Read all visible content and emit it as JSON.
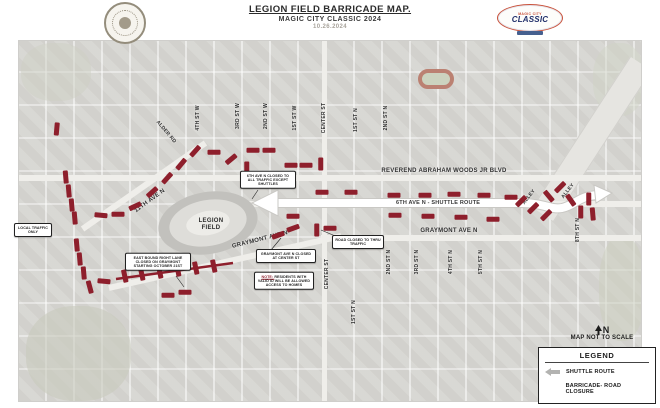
{
  "header": {
    "title": "LEGION FIELD BARRICADE MAP.",
    "subtitle": "MAGIC CITY CLASSIC 2024",
    "date": "10.26.2024"
  },
  "logos": {
    "classic": {
      "line1": "MAGIC CITY",
      "line2": "CLASSIC"
    }
  },
  "north": {
    "label": "N",
    "note": "MAP NOT TO SCALE"
  },
  "legend": {
    "title": "LEGEND",
    "items": [
      {
        "icon": "shuttle-arrow-icon",
        "label": "SHUTTLE ROUTE"
      },
      {
        "icon": "barricade-swatch",
        "label": "BARRICADE- ROAD CLOSURE"
      }
    ]
  },
  "map": {
    "stadium_label": "LEGION FIELD",
    "route_label": "6TH AVE N - SHUTTLE ROUTE",
    "colors": {
      "barricade": "#8e1f2c",
      "route": "#ffffff",
      "map_bg": "#d7d6d2"
    },
    "streets": [
      {
        "label": "ALDER RD",
        "x": 166,
        "y": 132,
        "rot": 50,
        "size": 5
      },
      {
        "label": "4TH ST W",
        "x": 198,
        "y": 118,
        "rot": -90,
        "size": 5
      },
      {
        "label": "3RD ST W",
        "x": 238,
        "y": 116,
        "rot": -90,
        "size": 5
      },
      {
        "label": "2ND ST W",
        "x": 266,
        "y": 116,
        "rot": -90,
        "size": 5
      },
      {
        "label": "1ST ST W",
        "x": 295,
        "y": 118,
        "rot": -90,
        "size": 5
      },
      {
        "label": "CENTER ST",
        "x": 324,
        "y": 118,
        "rot": -90,
        "size": 5
      },
      {
        "label": "1ST ST N",
        "x": 356,
        "y": 120,
        "rot": -90,
        "size": 5
      },
      {
        "label": "2ND ST N",
        "x": 386,
        "y": 118,
        "rot": -90,
        "size": 5
      },
      {
        "label": "REVEREND ABRAHAM WOODS JR BLVD",
        "x": 444,
        "y": 171,
        "rot": 0,
        "size": 6
      },
      {
        "label": "GRAYMONT AVE N",
        "x": 449,
        "y": 231,
        "rot": 0,
        "size": 6
      },
      {
        "label": "GRAYMONT AVE N",
        "x": 260,
        "y": 240,
        "rot": -14,
        "size": 6
      },
      {
        "label": "11TH AVE N",
        "x": 150,
        "y": 201,
        "rot": -36,
        "size": 6
      },
      {
        "label": "2ND ST N",
        "x": 389,
        "y": 262,
        "rot": -90,
        "size": 5
      },
      {
        "label": "3RD ST N",
        "x": 417,
        "y": 262,
        "rot": -90,
        "size": 5
      },
      {
        "label": "4TH ST N",
        "x": 451,
        "y": 262,
        "rot": -90,
        "size": 5
      },
      {
        "label": "5TH ST N",
        "x": 481,
        "y": 262,
        "rot": -90,
        "size": 5
      },
      {
        "label": "CENTER ST",
        "x": 327,
        "y": 274,
        "rot": -90,
        "size": 5
      },
      {
        "label": "1ST ST N",
        "x": 354,
        "y": 312,
        "rot": -90,
        "size": 5
      },
      {
        "label": "ALLEY",
        "x": 529,
        "y": 197,
        "rot": -52,
        "size": 5
      },
      {
        "label": "ALLEY",
        "x": 568,
        "y": 191,
        "rot": -52,
        "size": 5
      },
      {
        "label": "8TH ST N",
        "x": 578,
        "y": 230,
        "rot": -90,
        "size": 5
      }
    ],
    "callouts": [
      {
        "x": 158,
        "y": 262,
        "w": 60,
        "text": "EAST BOUND RIGHT LANE CLOSED ON GRAYMONT STARTING OCTOBER 21ST"
      },
      {
        "x": 268,
        "y": 180,
        "w": 50,
        "text": "6TH AVE N CLOSED TO ALL TRAFFIC EXCEPT SHUTTLES"
      },
      {
        "x": 286,
        "y": 256,
        "w": 54,
        "text": "GRAYMONT AVE N CLOSED AT CENTER ST"
      },
      {
        "x": 284,
        "y": 281,
        "w": 54,
        "highlight": "NOTE:",
        "text": "RESIDENTS WITH VALID ID WILL BE ALLOWED ACCESS TO HOMES"
      },
      {
        "x": 358,
        "y": 242,
        "w": 46,
        "text": "ROAD CLOSED TO THRU TRAFFIC"
      },
      {
        "x": 33,
        "y": 230,
        "w": 32,
        "text": "LOCAL TRAFFIC ONLY"
      }
    ],
    "leader_lines": [
      {
        "x1": 176,
        "y1": 276,
        "x2": 184,
        "y2": 287
      },
      {
        "x1": 258,
        "y1": 190,
        "x2": 252,
        "y2": 199
      },
      {
        "x1": 271,
        "y1": 250,
        "x2": 281,
        "y2": 238
      },
      {
        "x1": 340,
        "y1": 238,
        "x2": 321,
        "y2": 230
      }
    ],
    "closure_line": {
      "x1": 116,
      "y1": 279,
      "x2": 233,
      "y2": 263
    },
    "barricades": [
      {
        "x": 57,
        "y": 129,
        "r": 95
      },
      {
        "x": 66,
        "y": 177,
        "r": 85
      },
      {
        "x": 69,
        "y": 191,
        "r": 85
      },
      {
        "x": 72,
        "y": 205,
        "r": 85
      },
      {
        "x": 75,
        "y": 218,
        "r": 85
      },
      {
        "x": 77,
        "y": 245,
        "r": 85
      },
      {
        "x": 80,
        "y": 259,
        "r": 85
      },
      {
        "x": 84,
        "y": 273,
        "r": 85
      },
      {
        "x": 90,
        "y": 287,
        "r": 75
      },
      {
        "x": 101,
        "y": 215,
        "r": 5
      },
      {
        "x": 118,
        "y": 214,
        "r": 0
      },
      {
        "x": 135,
        "y": 206,
        "r": -25
      },
      {
        "x": 152,
        "y": 192,
        "r": -42
      },
      {
        "x": 167,
        "y": 178,
        "r": -48
      },
      {
        "x": 181,
        "y": 164,
        "r": -50
      },
      {
        "x": 195,
        "y": 151,
        "r": -48
      },
      {
        "x": 214,
        "y": 152,
        "r": 0
      },
      {
        "x": 231,
        "y": 159,
        "r": -40
      },
      {
        "x": 253,
        "y": 150,
        "r": 0
      },
      {
        "x": 269,
        "y": 150,
        "r": 0
      },
      {
        "x": 247,
        "y": 168,
        "r": 90
      },
      {
        "x": 291,
        "y": 165,
        "r": 0
      },
      {
        "x": 306,
        "y": 165,
        "r": 0
      },
      {
        "x": 321,
        "y": 164,
        "r": 90
      },
      {
        "x": 322,
        "y": 192,
        "r": 0
      },
      {
        "x": 351,
        "y": 192,
        "r": 0
      },
      {
        "x": 293,
        "y": 216,
        "r": 0
      },
      {
        "x": 394,
        "y": 195,
        "r": 0
      },
      {
        "x": 425,
        "y": 195,
        "r": 0
      },
      {
        "x": 454,
        "y": 194,
        "r": 0
      },
      {
        "x": 484,
        "y": 195,
        "r": 0
      },
      {
        "x": 511,
        "y": 197,
        "r": 0
      },
      {
        "x": 395,
        "y": 215,
        "r": 0
      },
      {
        "x": 428,
        "y": 216,
        "r": 0
      },
      {
        "x": 461,
        "y": 217,
        "r": 0
      },
      {
        "x": 493,
        "y": 219,
        "r": 0
      },
      {
        "x": 521,
        "y": 201,
        "r": -45
      },
      {
        "x": 533,
        "y": 208,
        "r": -45
      },
      {
        "x": 546,
        "y": 215,
        "r": -45
      },
      {
        "x": 549,
        "y": 196,
        "r": 50
      },
      {
        "x": 560,
        "y": 187,
        "r": -45
      },
      {
        "x": 571,
        "y": 200,
        "r": 55
      },
      {
        "x": 581,
        "y": 212,
        "r": 90
      },
      {
        "x": 589,
        "y": 199,
        "r": 90
      },
      {
        "x": 593,
        "y": 214,
        "r": 85
      },
      {
        "x": 278,
        "y": 235,
        "r": -20
      },
      {
        "x": 293,
        "y": 228,
        "r": -20
      },
      {
        "x": 317,
        "y": 230,
        "r": 90
      },
      {
        "x": 330,
        "y": 228,
        "r": 0
      },
      {
        "x": 125,
        "y": 276,
        "r": 78
      },
      {
        "x": 142,
        "y": 274,
        "r": 78
      },
      {
        "x": 160,
        "y": 272,
        "r": 78
      },
      {
        "x": 178,
        "y": 270,
        "r": 78
      },
      {
        "x": 196,
        "y": 268,
        "r": 78
      },
      {
        "x": 214,
        "y": 266,
        "r": 78
      },
      {
        "x": 104,
        "y": 281,
        "r": 5
      },
      {
        "x": 168,
        "y": 295,
        "r": 0
      },
      {
        "x": 185,
        "y": 292,
        "r": 0
      }
    ]
  }
}
